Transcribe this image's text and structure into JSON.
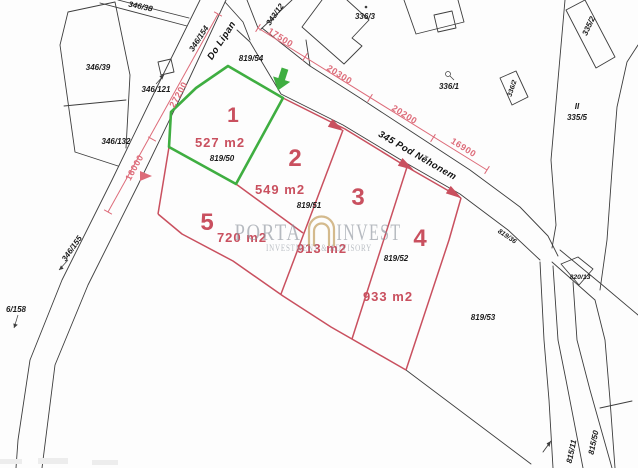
{
  "watermark": {
    "brand_left": "PORTA",
    "brand_right": "INVEST",
    "subtitle": "INVESTMENT & ADVISORY",
    "icon": "arch-gate-icon"
  },
  "roads": {
    "do_lipan": "Do Lipan",
    "pod_nehonem": "345 Pod Něhonem"
  },
  "plots": [
    {
      "number": "1",
      "area": "527 m2",
      "parcel": "819/50",
      "highlighted": true
    },
    {
      "number": "2",
      "area": "549 m2",
      "parcel": "819/51",
      "highlighted": false
    },
    {
      "number": "3",
      "area": "913 m2",
      "parcel": "",
      "highlighted": false
    },
    {
      "number": "4",
      "area": "933 m2",
      "parcel": "819/52",
      "highlighted": false
    },
    {
      "number": "5",
      "area": "720 m2",
      "parcel": "",
      "highlighted": false
    }
  ],
  "parcel_labels": {
    "l346_38": "346/38",
    "l346_39": "346/39",
    "l346_121": "346/121",
    "l346_132": "346/132",
    "l346_154": "346/154",
    "l343_12": "343/12",
    "l819_54": "819/54",
    "l336_3": "336/3",
    "l336_1": "336/1",
    "l336_2": "336/2",
    "l335_2": "335/2",
    "l335_5": "335/5",
    "l335_5_mark": "II",
    "l346_155": "346/155",
    "l6_158": "6/158",
    "l819_36": "819/36",
    "l820_13": "820/13",
    "l819_53": "819/53",
    "l815_11": "815/11",
    "l815_50": "815/50"
  },
  "dimensions": {
    "d27200": "27200",
    "d16000": "16000",
    "d17500": "17500",
    "d20300": "20300",
    "d20200": "20200",
    "d16900": "16900"
  },
  "colors": {
    "highlight_green": "#3fae41",
    "plot_red": "#c9505f",
    "dim_red": "#dd6b79",
    "line_black": "#3d3d3d",
    "wm_gray": "#8b929c",
    "wm_gold": "#c3a061"
  }
}
